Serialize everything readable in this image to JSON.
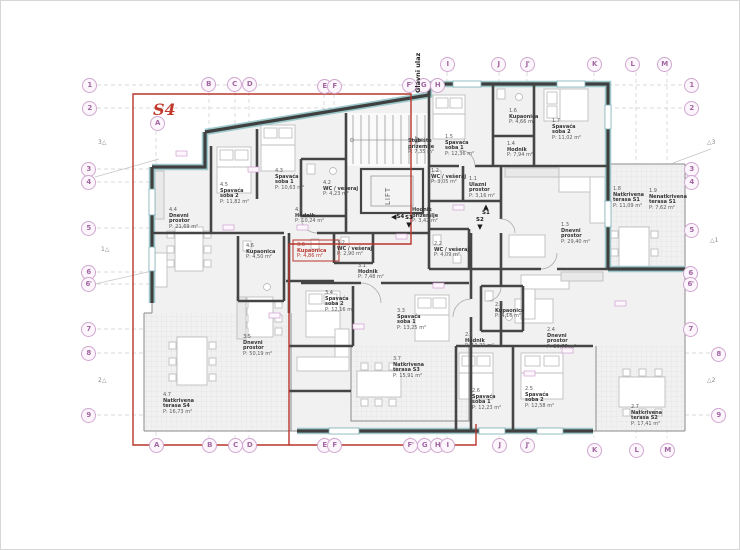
{
  "colors": {
    "boundary_red": "#b8352c",
    "grid_marker": "#a268a2",
    "wall": "#3f3f3f",
    "insulation_teal": "#9cc8cb"
  },
  "plan": {
    "s4": "S4",
    "entrance": "Glavni ulaz",
    "lift": "LIFT",
    "core_rooms": [
      {
        "name": "Stubište prizemlje",
        "area": "P: 7,35 m²",
        "x": 407,
        "y": 138
      },
      {
        "name": "Hodnik prizemlje",
        "area": "P: 3,42 m²",
        "x": 411,
        "y": 207
      }
    ],
    "unit_markers": [
      {
        "label": "S4",
        "dir": "left",
        "x": 390,
        "y": 208
      },
      {
        "label": "S3",
        "dir": "down",
        "x": 404,
        "y": 215
      },
      {
        "label": "S1",
        "dir": "up",
        "x": 481,
        "y": 203
      },
      {
        "label": "S2",
        "dir": "down",
        "x": 475,
        "y": 217
      }
    ],
    "rooms": [
      {
        "id": "1.1",
        "name": "Ulazni prostor",
        "area": "P: 3,16 m²",
        "x": 468,
        "y": 176
      },
      {
        "id": "1.2",
        "name": "WC / vešeraj",
        "area": "P: 3,05 m²",
        "x": 430,
        "y": 168
      },
      {
        "id": "1.3",
        "name": "Dnevni prostor",
        "area": "P: 29,40 m²",
        "x": 560,
        "y": 222
      },
      {
        "id": "1.4",
        "name": "Hodnik",
        "area": "P: 7,94 m²",
        "x": 506,
        "y": 141
      },
      {
        "id": "1.5",
        "name": "Spavaća soba 1",
        "area": "P: 12,36 m²",
        "x": 444,
        "y": 134
      },
      {
        "id": "1.6",
        "name": "Kupaonica",
        "area": "P: 4,66 m²",
        "x": 508,
        "y": 108
      },
      {
        "id": "1.7",
        "name": "Spavaća soba 2",
        "area": "P: 11,02 m²",
        "x": 551,
        "y": 118
      },
      {
        "id": "1.8",
        "name": "Natkrivena terasa S1",
        "area": "P: 11,09 m²",
        "x": 612,
        "y": 186
      },
      {
        "id": "1.9",
        "name": "Nenatkrivena terasa S1",
        "area": "P: 7,62 m²",
        "x": 648,
        "y": 188
      },
      {
        "id": "2.1",
        "name": "Hodnik",
        "area": "P: 11,21 m²",
        "x": 464,
        "y": 332
      },
      {
        "id": "2.2",
        "name": "WC / vešeraj",
        "area": "P: 4,09 m²",
        "x": 433,
        "y": 241
      },
      {
        "id": "2.3",
        "name": "Kupaonica",
        "area": "P: 4,16 m²",
        "x": 494,
        "y": 302
      },
      {
        "id": "2.4",
        "name": "Dnevni prostor",
        "area": "P: 30,77 m²",
        "x": 546,
        "y": 327
      },
      {
        "id": "2.5",
        "name": "Spavaća soba 2",
        "area": "P: 12,58 m²",
        "x": 524,
        "y": 386
      },
      {
        "id": "2.6",
        "name": "Spavaća soba 1",
        "area": "P: 12,23 m²",
        "x": 471,
        "y": 388
      },
      {
        "id": "2.7",
        "name": "Natkrivena terasa S2",
        "area": "P: 17,41 m²",
        "x": 630,
        "y": 404
      },
      {
        "id": "3.1",
        "name": "Hodnik",
        "area": "P: 7,48 m²",
        "x": 357,
        "y": 263
      },
      {
        "id": "3.2",
        "name": "WC / vešeraj",
        "area": "P: 2,90 m²",
        "x": 336,
        "y": 240
      },
      {
        "id": "3.3",
        "name": "Spavaća soba 1",
        "area": "P: 13,25 m²",
        "x": 396,
        "y": 308
      },
      {
        "id": "3.4",
        "name": "Spavaća soba 2",
        "area": "P: 12,16 m²",
        "x": 324,
        "y": 290
      },
      {
        "id": "3.5",
        "name": "Dnevni prostor",
        "area": "P: 50,19 m²",
        "x": 242,
        "y": 334
      },
      {
        "id": "3.6",
        "name": "Kupaonica",
        "area": "P: 4,86 m²",
        "x": 296,
        "y": 242,
        "red": true
      },
      {
        "id": "3.7",
        "name": "Natkrivena terasa S3",
        "area": "P: 15,91 m²",
        "x": 392,
        "y": 356
      },
      {
        "id": "4.1",
        "name": "Hodnik",
        "area": "P: 10,24 m²",
        "x": 294,
        "y": 207
      },
      {
        "id": "4.2",
        "name": "WC / vešeraj",
        "area": "P: 4,23 m²",
        "x": 322,
        "y": 180
      },
      {
        "id": "4.3",
        "name": "Spavaća soba 1",
        "area": "P: 10,63 m²",
        "x": 274,
        "y": 168
      },
      {
        "id": "4.4",
        "name": "Dnevni prostor",
        "area": "P: 21,69 m²",
        "x": 168,
        "y": 207
      },
      {
        "id": "4.5",
        "name": "Spavaća soba 2",
        "area": "P: 11,82 m²",
        "x": 219,
        "y": 182
      },
      {
        "id": "4.6",
        "name": "Kupaonica",
        "area": "P: 4,50 m²",
        "x": 245,
        "y": 243
      },
      {
        "id": "4.7",
        "name": "Natkrivena terasa S4",
        "area": "P: 16,73 m²",
        "x": 162,
        "y": 392
      }
    ]
  },
  "grid": {
    "top": [
      {
        "t": "A",
        "x": 156,
        "y": 122
      },
      {
        "t": "B",
        "x": 207,
        "y": 83
      },
      {
        "t": "C",
        "x": 233,
        "y": 83
      },
      {
        "t": "D",
        "x": 248,
        "y": 83
      },
      {
        "t": "E",
        "x": 323,
        "y": 85
      },
      {
        "t": "F",
        "x": 333,
        "y": 85
      },
      {
        "t": "F'",
        "x": 408,
        "y": 84
      },
      {
        "t": "G",
        "x": 422,
        "y": 84
      },
      {
        "t": "H",
        "x": 436,
        "y": 84
      },
      {
        "t": "I",
        "x": 446,
        "y": 63
      },
      {
        "t": "J",
        "x": 497,
        "y": 63
      },
      {
        "t": "J'",
        "x": 526,
        "y": 63
      },
      {
        "t": "K",
        "x": 593,
        "y": 63
      },
      {
        "t": "L",
        "x": 631,
        "y": 63
      },
      {
        "t": "M",
        "x": 663,
        "y": 63
      }
    ],
    "bottom": [
      {
        "t": "A",
        "x": 155,
        "y": 444
      },
      {
        "t": "B",
        "x": 208,
        "y": 444
      },
      {
        "t": "C",
        "x": 234,
        "y": 444
      },
      {
        "t": "D",
        "x": 248,
        "y": 444
      },
      {
        "t": "E",
        "x": 323,
        "y": 444
      },
      {
        "t": "F",
        "x": 333,
        "y": 444
      },
      {
        "t": "F'",
        "x": 409,
        "y": 444
      },
      {
        "t": "G",
        "x": 423,
        "y": 444
      },
      {
        "t": "H",
        "x": 436,
        "y": 444
      },
      {
        "t": "I",
        "x": 446,
        "y": 444
      },
      {
        "t": "J",
        "x": 498,
        "y": 444
      },
      {
        "t": "J'",
        "x": 526,
        "y": 444
      },
      {
        "t": "K",
        "x": 593,
        "y": 449
      },
      {
        "t": "L",
        "x": 635,
        "y": 449
      },
      {
        "t": "M",
        "x": 666,
        "y": 449
      }
    ],
    "left": [
      {
        "t": "1",
        "x": 88,
        "y": 84
      },
      {
        "t": "2",
        "x": 88,
        "y": 107
      },
      {
        "t": "3",
        "x": 87,
        "y": 168
      },
      {
        "t": "4",
        "x": 87,
        "y": 181
      },
      {
        "t": "5",
        "x": 87,
        "y": 227
      },
      {
        "t": "6",
        "x": 87,
        "y": 271
      },
      {
        "t": "6'",
        "x": 87,
        "y": 283
      },
      {
        "t": "7",
        "x": 87,
        "y": 328
      },
      {
        "t": "8",
        "x": 87,
        "y": 352
      },
      {
        "t": "9",
        "x": 87,
        "y": 414
      }
    ],
    "right": [
      {
        "t": "1",
        "x": 690,
        "y": 84
      },
      {
        "t": "2",
        "x": 690,
        "y": 107
      },
      {
        "t": "3",
        "x": 690,
        "y": 168
      },
      {
        "t": "4",
        "x": 690,
        "y": 181
      },
      {
        "t": "5",
        "x": 690,
        "y": 229
      },
      {
        "t": "6",
        "x": 689,
        "y": 272
      },
      {
        "t": "6'",
        "x": 689,
        "y": 283
      },
      {
        "t": "7",
        "x": 689,
        "y": 328
      },
      {
        "t": "8",
        "x": 717,
        "y": 353
      },
      {
        "t": "9",
        "x": 717,
        "y": 414
      }
    ],
    "sections_left": [
      {
        "t": "3",
        "x": 97,
        "y": 142
      },
      {
        "t": "1",
        "x": 100,
        "y": 249
      },
      {
        "t": "2",
        "x": 97,
        "y": 380
      }
    ],
    "sections_right": [
      {
        "t": "3",
        "x": 706,
        "y": 142
      },
      {
        "t": "1",
        "x": 709,
        "y": 240
      },
      {
        "t": "2",
        "x": 706,
        "y": 380
      }
    ]
  }
}
